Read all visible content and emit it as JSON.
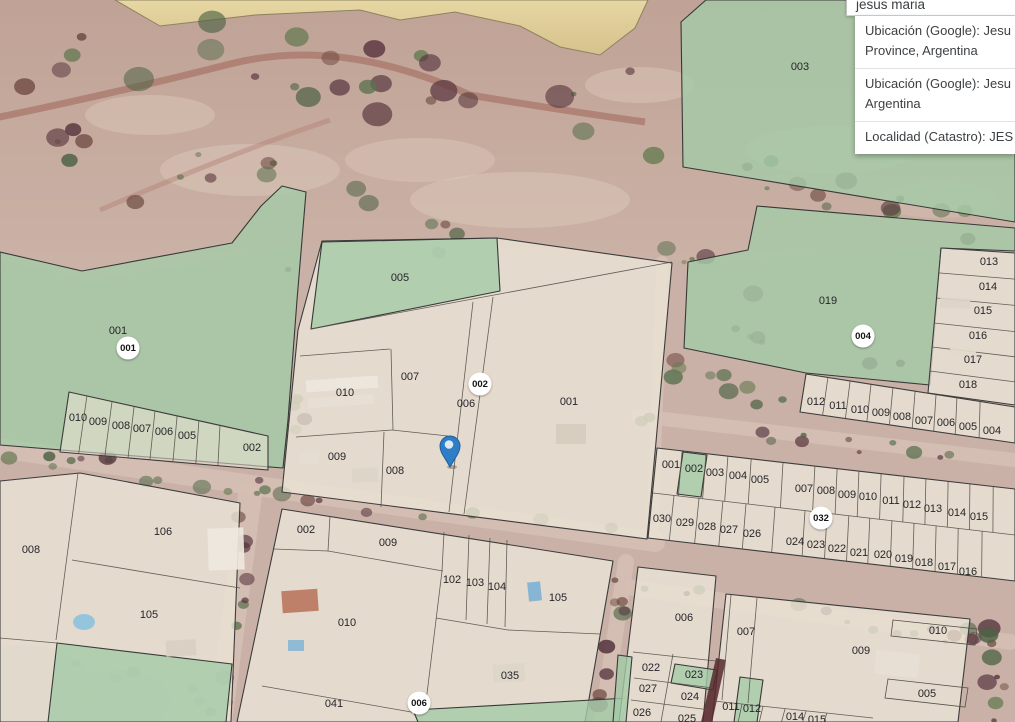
{
  "search": {
    "query": "jesus maria",
    "results": [
      {
        "line1": "Ubicación (Google): Jesu",
        "line2": "Province, Argentina"
      },
      {
        "line1": "Ubicación (Google): Jesu",
        "line2": "Argentina"
      },
      {
        "line1": "Localidad (Catastro): JES",
        "line2": ""
      }
    ]
  },
  "map": {
    "marker": {
      "x": 450,
      "y": 446,
      "color": "#2d7ec6"
    },
    "badges": [
      {
        "label": "001",
        "x": 128,
        "y": 348
      },
      {
        "label": "002",
        "x": 480,
        "y": 384
      },
      {
        "label": "004",
        "x": 863,
        "y": 336
      },
      {
        "label": "032",
        "x": 821,
        "y": 518
      },
      {
        "label": "006",
        "x": 419,
        "y": 703
      }
    ],
    "parcel_labels": [
      [
        "001",
        118,
        331
      ],
      [
        "010",
        78,
        418
      ],
      [
        "009",
        98,
        422
      ],
      [
        "008",
        121,
        426
      ],
      [
        "007",
        142,
        429
      ],
      [
        "006",
        164,
        432
      ],
      [
        "005",
        187,
        436
      ],
      [
        "002",
        252,
        448
      ],
      [
        "005",
        400,
        278
      ],
      [
        "007",
        410,
        377
      ],
      [
        "010",
        345,
        393
      ],
      [
        "006",
        466,
        404
      ],
      [
        "001",
        569,
        402
      ],
      [
        "009",
        337,
        457
      ],
      [
        "008",
        395,
        471
      ],
      [
        "003",
        800,
        67
      ],
      [
        "019",
        828,
        301
      ],
      [
        "013",
        989,
        262
      ],
      [
        "014",
        988,
        287
      ],
      [
        "015",
        983,
        311
      ],
      [
        "016",
        978,
        336
      ],
      [
        "017",
        973,
        360
      ],
      [
        "018",
        968,
        385
      ],
      [
        "012",
        816,
        402
      ],
      [
        "011",
        838,
        406
      ],
      [
        "010",
        860,
        410
      ],
      [
        "009",
        881,
        413
      ],
      [
        "008",
        902,
        417
      ],
      [
        "007",
        924,
        421
      ],
      [
        "006",
        946,
        423
      ],
      [
        "005",
        968,
        427
      ],
      [
        "004",
        992,
        431
      ],
      [
        "001",
        671,
        465
      ],
      [
        "002",
        694,
        469
      ],
      [
        "003",
        715,
        473
      ],
      [
        "004",
        738,
        476
      ],
      [
        "005",
        760,
        480
      ],
      [
        "007",
        804,
        489
      ],
      [
        "008",
        826,
        491
      ],
      [
        "009",
        847,
        495
      ],
      [
        "010",
        868,
        497
      ],
      [
        "011",
        891,
        501
      ],
      [
        "012",
        912,
        505
      ],
      [
        "013",
        933,
        509
      ],
      [
        "014",
        957,
        513
      ],
      [
        "015",
        979,
        517
      ],
      [
        "030",
        662,
        519
      ],
      [
        "029",
        685,
        523
      ],
      [
        "028",
        707,
        527
      ],
      [
        "027",
        729,
        530
      ],
      [
        "026",
        752,
        534
      ],
      [
        "024",
        795,
        542
      ],
      [
        "023",
        816,
        545
      ],
      [
        "022",
        837,
        549
      ],
      [
        "021",
        859,
        553
      ],
      [
        "020",
        883,
        555
      ],
      [
        "019",
        904,
        559
      ],
      [
        "018",
        924,
        563
      ],
      [
        "017",
        947,
        567
      ],
      [
        "016",
        968,
        572
      ],
      [
        "008",
        31,
        550
      ],
      [
        "106",
        163,
        532
      ],
      [
        "105",
        149,
        615
      ],
      [
        "002",
        306,
        530
      ],
      [
        "009",
        388,
        543
      ],
      [
        "102",
        452,
        580
      ],
      [
        "103",
        475,
        583
      ],
      [
        "104",
        497,
        587
      ],
      [
        "105",
        558,
        598
      ],
      [
        "010",
        347,
        623
      ],
      [
        "035",
        510,
        676
      ],
      [
        "041",
        334,
        704
      ],
      [
        "006",
        684,
        618
      ],
      [
        "007",
        746,
        632
      ],
      [
        "009",
        861,
        651
      ],
      [
        "010",
        938,
        631
      ],
      [
        "005",
        927,
        694
      ],
      [
        "022",
        651,
        668
      ],
      [
        "023",
        694,
        675
      ],
      [
        "027",
        648,
        689
      ],
      [
        "024",
        690,
        697
      ],
      [
        "026",
        642,
        713
      ],
      [
        "025",
        687,
        719
      ],
      [
        "011",
        731,
        707
      ],
      [
        "012",
        752,
        709
      ],
      [
        "014",
        795,
        717
      ],
      [
        "015",
        817,
        720
      ]
    ],
    "colors": {
      "green_parcel": "#a4caa8",
      "beige_parcel": "#ece5d7",
      "boundary": "#3c3c3c",
      "badge_bg": "#ffffff",
      "badge_text": "#141414",
      "label_text": "#26262b",
      "marker_blue": "#2d7ec6"
    }
  }
}
